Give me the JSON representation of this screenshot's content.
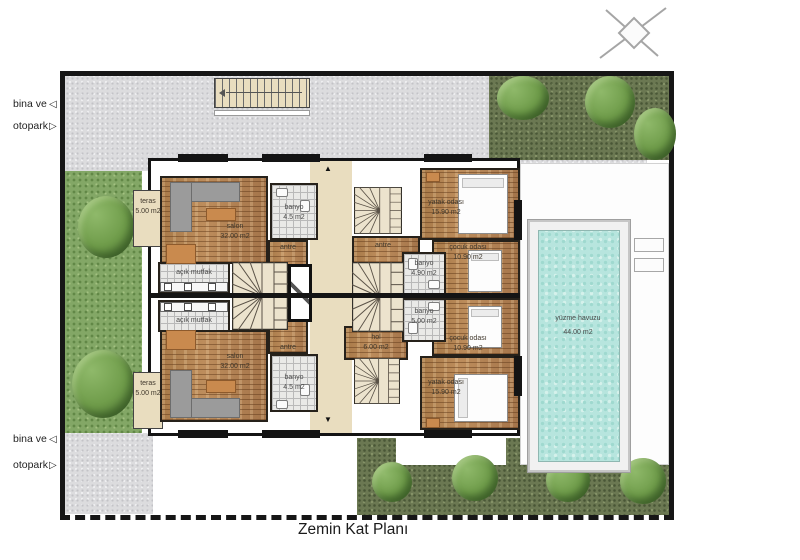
{
  "title": "Zemin Kat Planı",
  "annotations": {
    "top_left": {
      "line1": "bina ve",
      "line2": "otopark"
    },
    "bottom_left": {
      "line1": "bina ve",
      "line2": "otopark"
    }
  },
  "icons": {
    "compass": "crossed-diagonals-with-diamond",
    "entry_left": "◁",
    "entry_right": "▷",
    "corridor_up": "▲",
    "corridor_down": "▼"
  },
  "rooms": {
    "teras_top": {
      "name": "teras",
      "area": "5.00 m2"
    },
    "teras_bottom": {
      "name": "teras",
      "area": "5.00 m2"
    },
    "salon_top": {
      "name": "salon",
      "area": "32.00 m2"
    },
    "salon_bottom": {
      "name": "salon",
      "area": "32.00 m2"
    },
    "mutfak_top": {
      "name": "açık mutfak"
    },
    "mutfak_bottom": {
      "name": "açık mutfak"
    },
    "banyo_left_top": {
      "name": "banyo",
      "area": "4.5 m2"
    },
    "banyo_left_bottom": {
      "name": "banyo",
      "area": "4.5 m2"
    },
    "antre_left_top": {
      "name": "antre"
    },
    "antre_left_bottom": {
      "name": "antre"
    },
    "antre_right_top": {
      "name": "antre"
    },
    "hol": {
      "name": "hol",
      "area": "6.00 m2"
    },
    "yatak_top": {
      "name": "yatak odası",
      "area": "15.90 m2"
    },
    "yatak_bottom": {
      "name": "yatak odası",
      "area": "15.90 m2"
    },
    "cocuk_top": {
      "name": "çocuk odası",
      "area": "10.90 m2"
    },
    "cocuk_bottom": {
      "name": "çocuk odası",
      "area": "10.90 m2"
    },
    "banyo_right_top": {
      "name": "banyo",
      "area": "4.90 m2"
    },
    "banyo_right_bottom": {
      "name": "banyo",
      "area": "5.00 m2"
    },
    "pool": {
      "name": "yüzme havuzu",
      "area": "44.00 m2"
    }
  },
  "colors": {
    "wall": "#141414",
    "wood_floor": "#b18050",
    "paving": "#dcdcde",
    "grass_dark": "#6b7852",
    "grass_light": "#83a766",
    "pool_water": "#b7e5de",
    "terrace": "#e9ddbf"
  }
}
